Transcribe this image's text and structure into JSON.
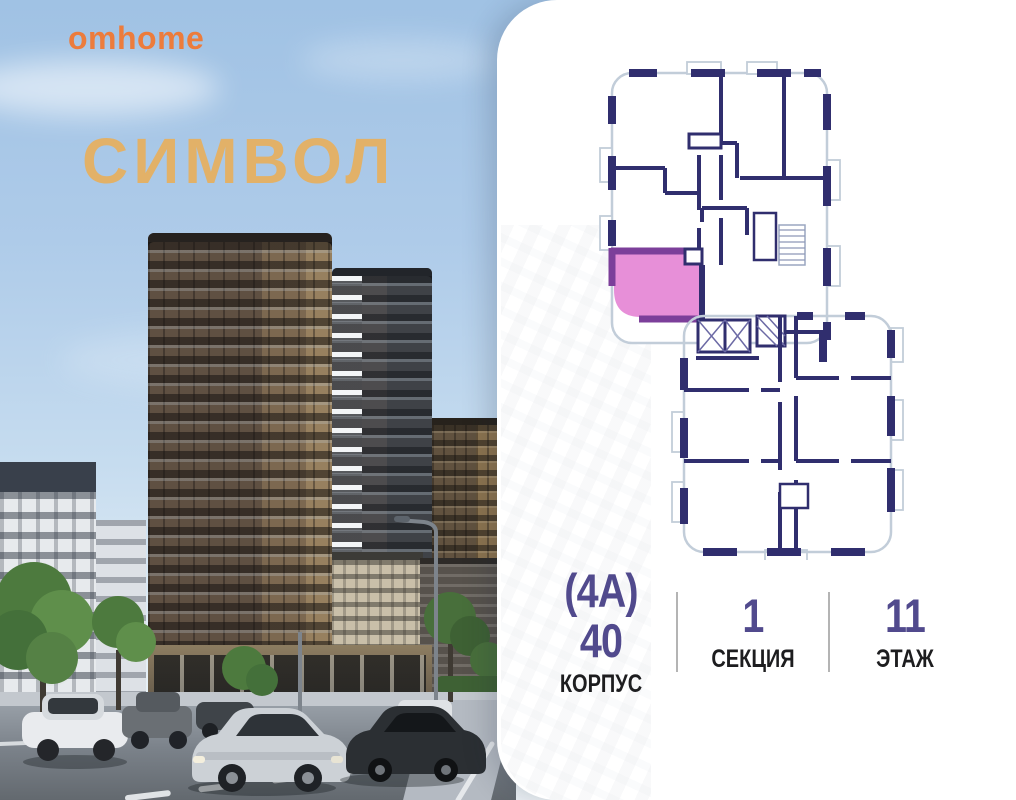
{
  "brand": {
    "logo": "omhome",
    "color": "#EC7C3C"
  },
  "project": {
    "title": "СИМВОЛ",
    "title_color": "#E2B168"
  },
  "floor_plan": {
    "description": "floor plan with one highlighted apartment",
    "highlight_color": "#E78FD8",
    "highlight_wall_color": "#7C3F9A",
    "wall_color": "#302E6E",
    "outline_color": "#C2CDD9"
  },
  "stats": {
    "value_color": "#514A8D",
    "label_color": "#1D1D1F",
    "items": [
      {
        "value": "(4А) 40",
        "label": "КОРПУС"
      },
      {
        "value": "1",
        "label": "СЕКЦИЯ"
      },
      {
        "value": "11",
        "label": "ЭТАЖ"
      }
    ]
  }
}
